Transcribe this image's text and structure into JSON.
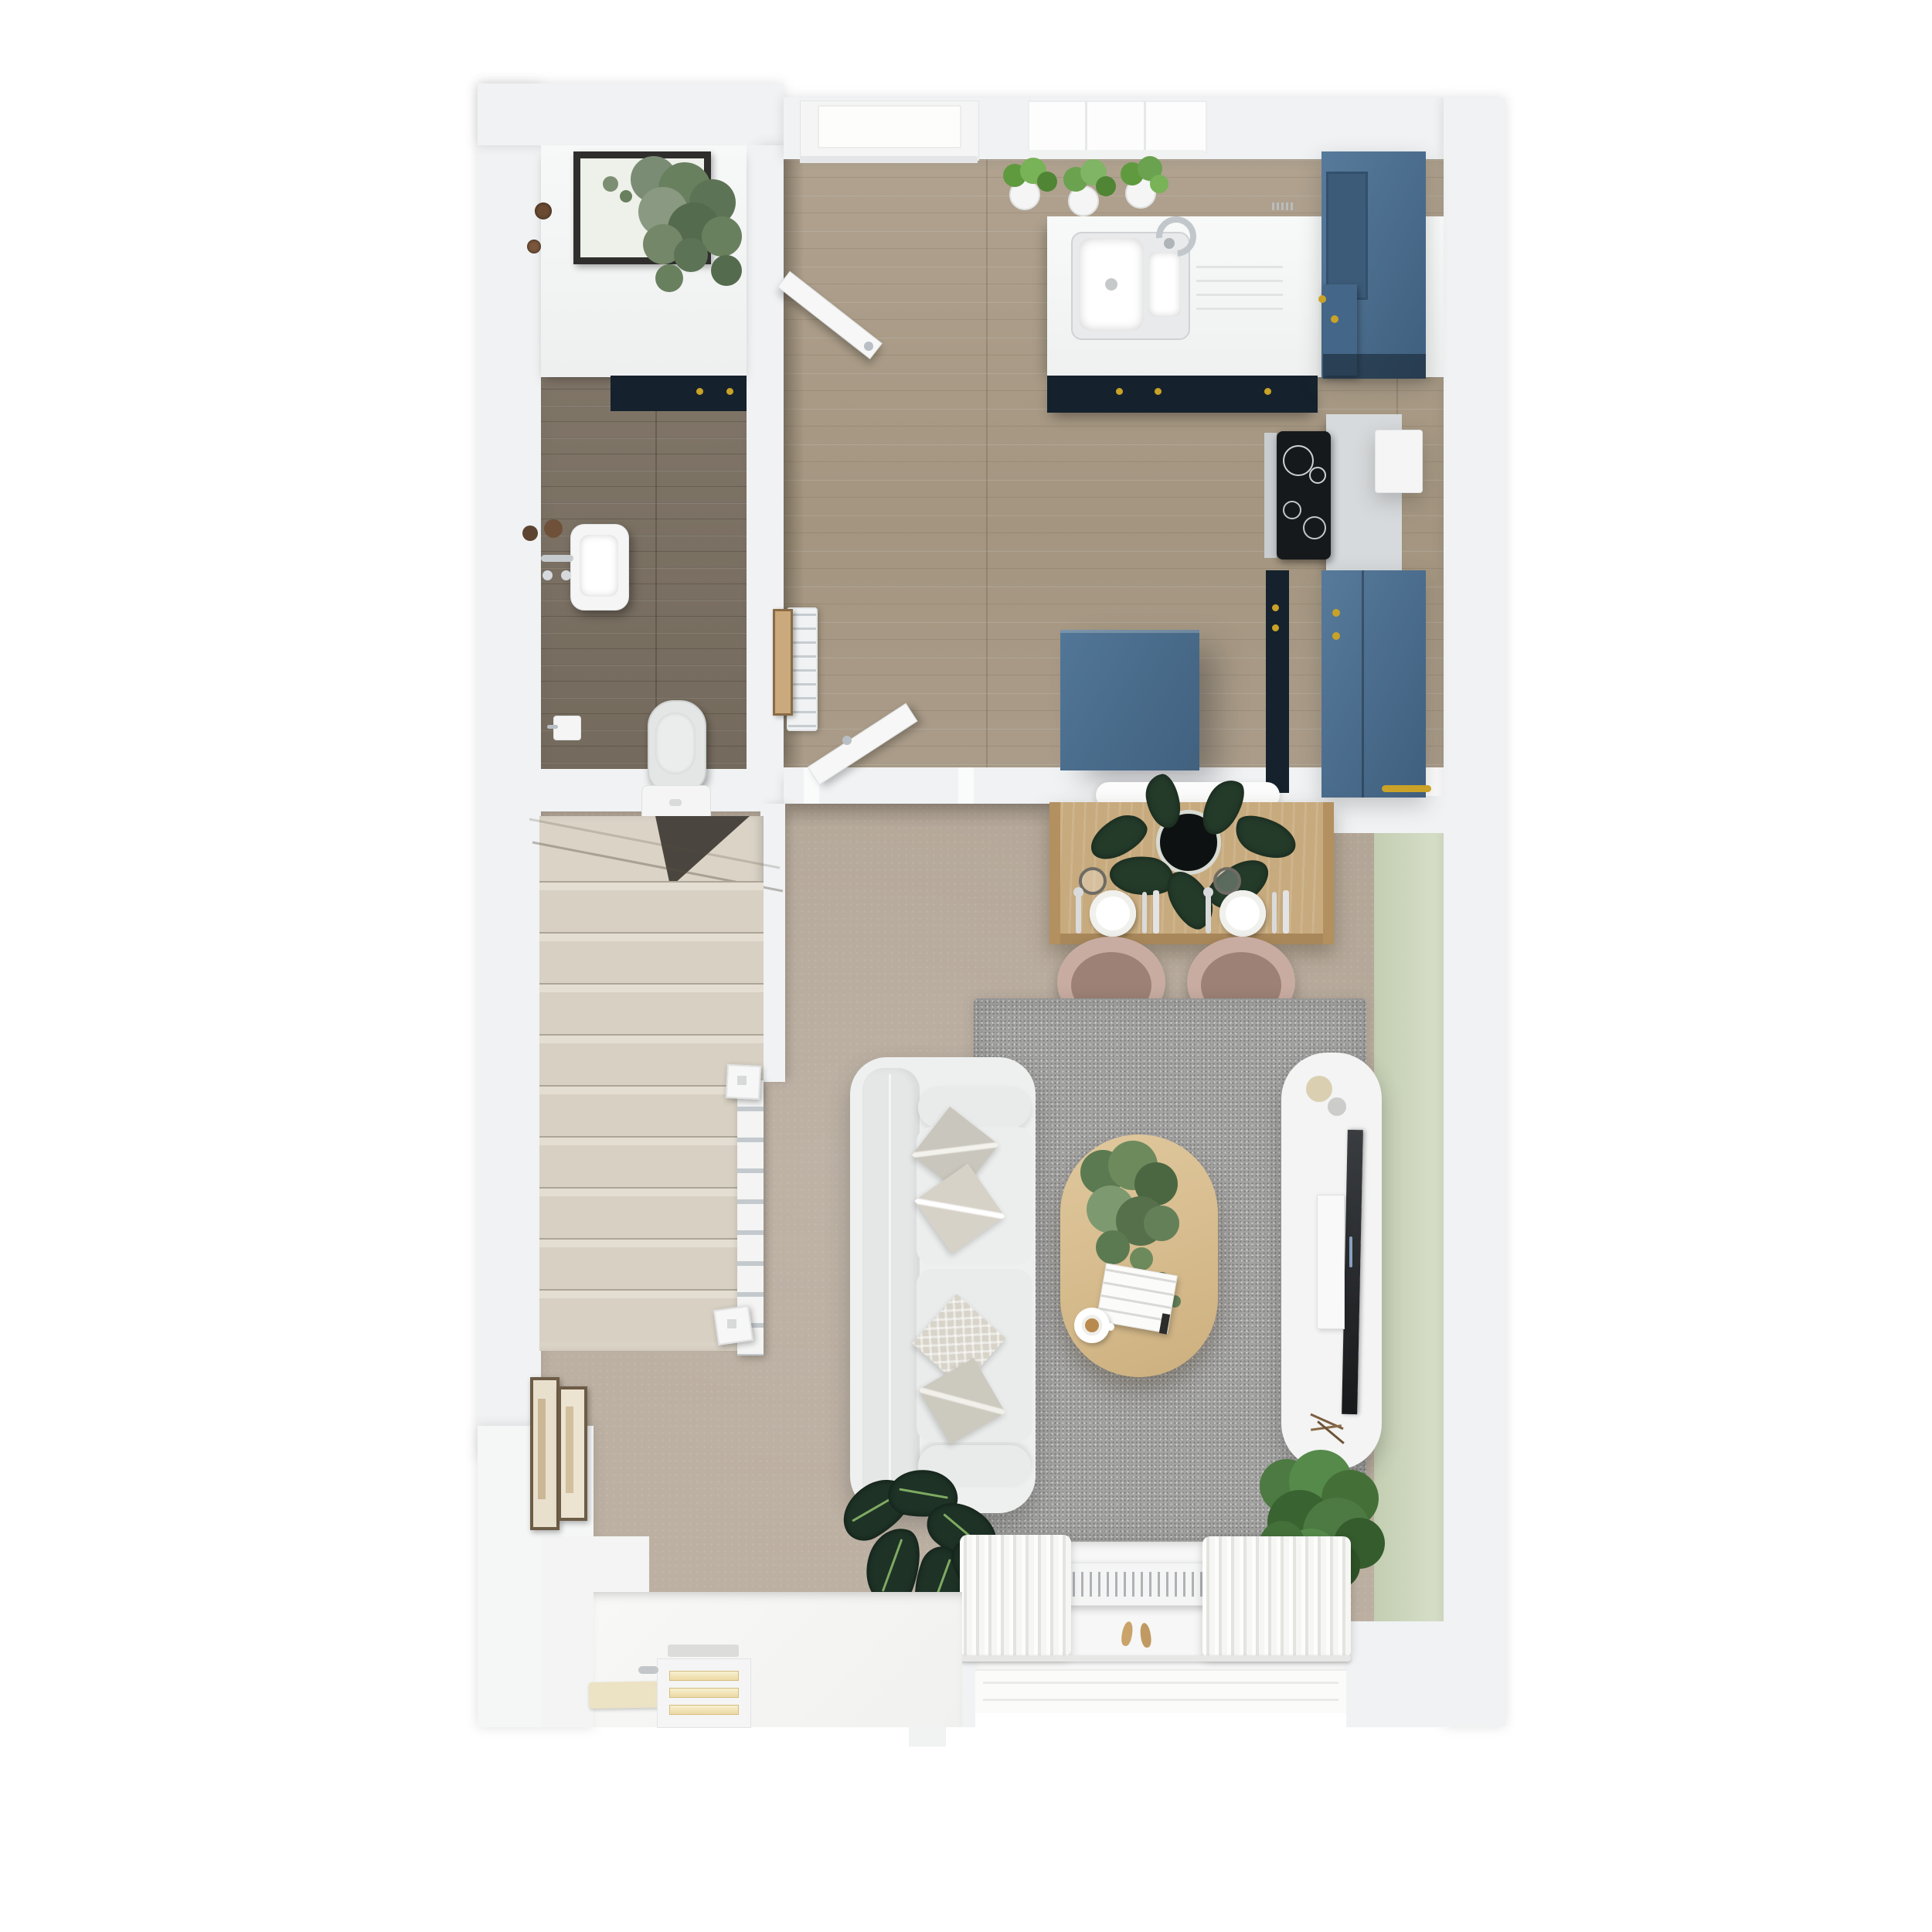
{
  "meta": {
    "title": "3D floor plan render — ground floor, top-down view",
    "style": "photoreal dollhouse render, no text labels visible"
  },
  "palette": {
    "background": "#ffffff",
    "wall": "#f0f2f4",
    "wc_floor_wood": "#7d7265",
    "kitchen_floor_wood": "#a59784",
    "living_floor": "#b5a99a",
    "stair_carpet": "#dad3c6",
    "rug_grey": "#a3a3a2",
    "cabinet_blue": "#4a6d8e",
    "cabinet_navy": "#15222d",
    "accent_wall_green": "#ccd6bd",
    "dining_table_wood": "#c7aa7d",
    "coffee_table_wood": "#d9bd90",
    "chair_blush": "#c8aca2",
    "sofa_grey": "#eef0ef",
    "gold_hardware": "#c9a227",
    "plant_green": "#5d7a52",
    "hob_black": "#16191c"
  },
  "rooms": {
    "wc": {
      "label": "Cloakroom / WC"
    },
    "kitchen": {
      "label": "Kitchen"
    },
    "living": {
      "label": "Open-plan living and dining room"
    },
    "hall": {
      "label": "Entrance hall and staircase"
    }
  },
  "furniture": {
    "wc_basin": "Hand basin with chrome taps",
    "toilet": "Toilet",
    "toilet_roll_holder": "Toilet roll holder",
    "wc_counter": "Counter with framed picture and eucalyptus plant",
    "towel_radiator": "Ladder towel radiator",
    "leaning_picture": "Leaning picture frame",
    "back_door": "Glazed back door",
    "kitchen_window": "Kitchen window with herb pots",
    "kitchen_sink": "Double-bowl sink with drainer and mixer tap",
    "kitchen_counter": "White worktop with navy base units",
    "wall_units": "Tall blue cabinets",
    "hob": "Induction hob with extractor box",
    "island": "Blue kitchen island",
    "kitchen_door": "Open door to living room",
    "wc_door": "Open cloakroom door",
    "wall_shelf_radiator": "White wall radiator above dining table",
    "dining_table": "Dining table set for two with monstera centrepiece",
    "dining_chairs": "Two blush tub chairs with gold legs",
    "rug": "Grey textured rug",
    "sofa": "Light grey two-seat sofa with four cushions",
    "coffee_table": "Oval oak coffee table with plant, book and coffee cup",
    "tv_unit": "White media unit with TV and soundbar",
    "accent_wall": "Sage green accent wall",
    "window_seat": "Rear window with curtains and radiator",
    "shoes": "Pair of shoes",
    "alocasia_plant": "Alocasia house plant",
    "floor_plant": "Potted green plant",
    "stairs": "Carpeted staircase with white balustrade",
    "hall_art": "Two framed artworks",
    "front_door": "Front door with letterbox",
    "door_mat": "Cream doormat"
  },
  "counts": {
    "stair_treads": 9,
    "herb_pots": 3,
    "dining_place_settings": 2,
    "sofa_cushions": 4
  }
}
